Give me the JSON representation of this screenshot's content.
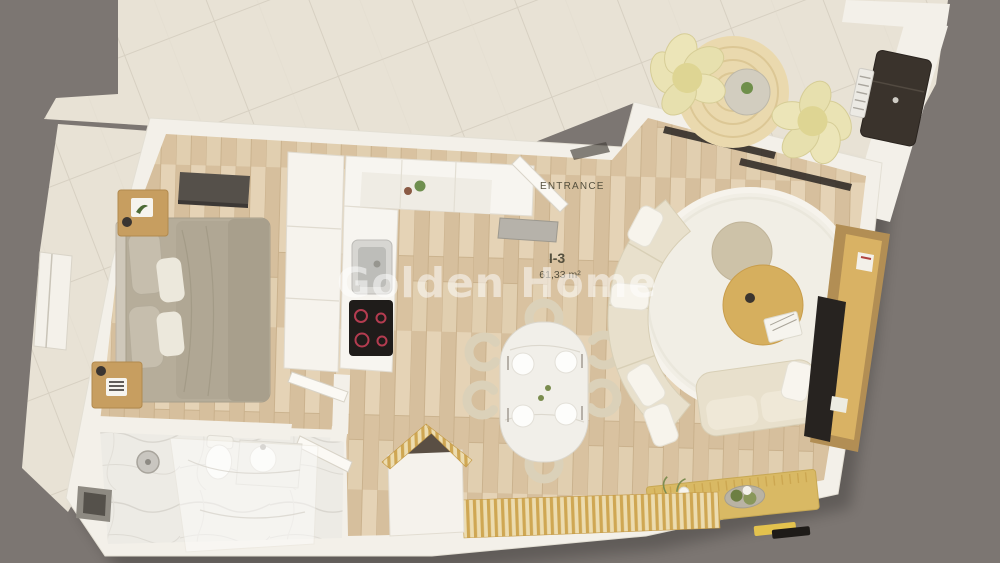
{
  "plan": {
    "watermark": "Golden Home",
    "entrance_label": "ENTRANCE",
    "unit_label": "I-3",
    "area_label": "61,33 m²",
    "colors": {
      "background": "#7c7672",
      "terrace_tile": "#e8e2d5",
      "wall": "#f3f0e9",
      "wood_floor": "#ddc8a9",
      "bathroom_marble": "#edebe5",
      "bed": "#b6ad9a",
      "sofa": "#e8e0cc",
      "rug": "#f1eee5",
      "accent_wood": "#d8b164",
      "dark_appliance": "#3a332c",
      "watermark_color": "#ffffff",
      "label_color": "#55503e"
    }
  }
}
